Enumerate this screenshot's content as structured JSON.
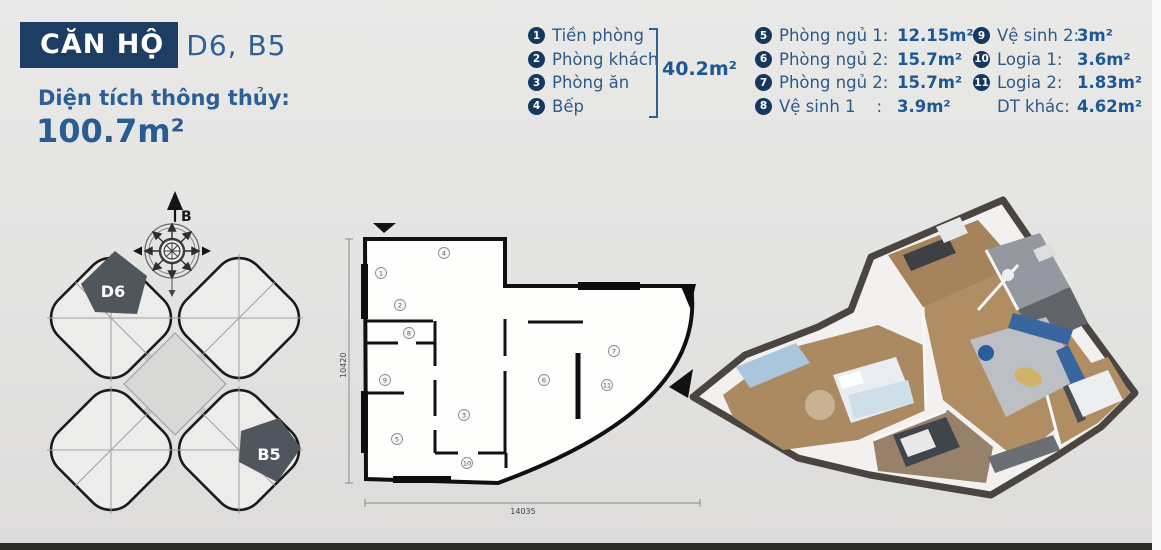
{
  "header": {
    "title": "CĂN HỘ",
    "units": "D6, B5",
    "area_label": "Diện tích thông thủy:",
    "area_value": "100.7m²"
  },
  "legend": {
    "group1": {
      "items": [
        {
          "num": "1",
          "label": "Tiền phòng"
        },
        {
          "num": "2",
          "label": "Phòng khách"
        },
        {
          "num": "3",
          "label": "Phòng ăn"
        },
        {
          "num": "4",
          "label": "Bếp"
        }
      ],
      "group_area": "40.2m²"
    },
    "group2": {
      "items": [
        {
          "num": "5",
          "label": "Phòng ngủ 1:",
          "value": "12.15m²"
        },
        {
          "num": "6",
          "label": "Phòng ngủ 2:",
          "value": "15.7m²"
        },
        {
          "num": "7",
          "label": "Phòng ngủ 2:",
          "value": "15.7m²"
        },
        {
          "num": "8",
          "label": "Vệ sinh 1    :",
          "value": "3.9m²"
        }
      ]
    },
    "group3": {
      "items": [
        {
          "num": "9",
          "label": "Vệ sinh 2:",
          "value": "3m²"
        },
        {
          "num": "10",
          "label": "Logia 1:",
          "value": "3.6m²"
        },
        {
          "num": "11",
          "label": "Logia 2:",
          "value": "1.83m²"
        },
        {
          "num": "",
          "label": "DT khác:",
          "value": "4.62m²"
        }
      ]
    }
  },
  "overview": {
    "compass_label": "B",
    "unit_top": "D6",
    "unit_bottom": "B5"
  },
  "floorplan": {
    "dim_width": "14035",
    "dim_height": "10420",
    "rooms": [
      "1",
      "2",
      "3",
      "4",
      "5",
      "6",
      "7",
      "8",
      "9",
      "10",
      "11"
    ]
  }
}
